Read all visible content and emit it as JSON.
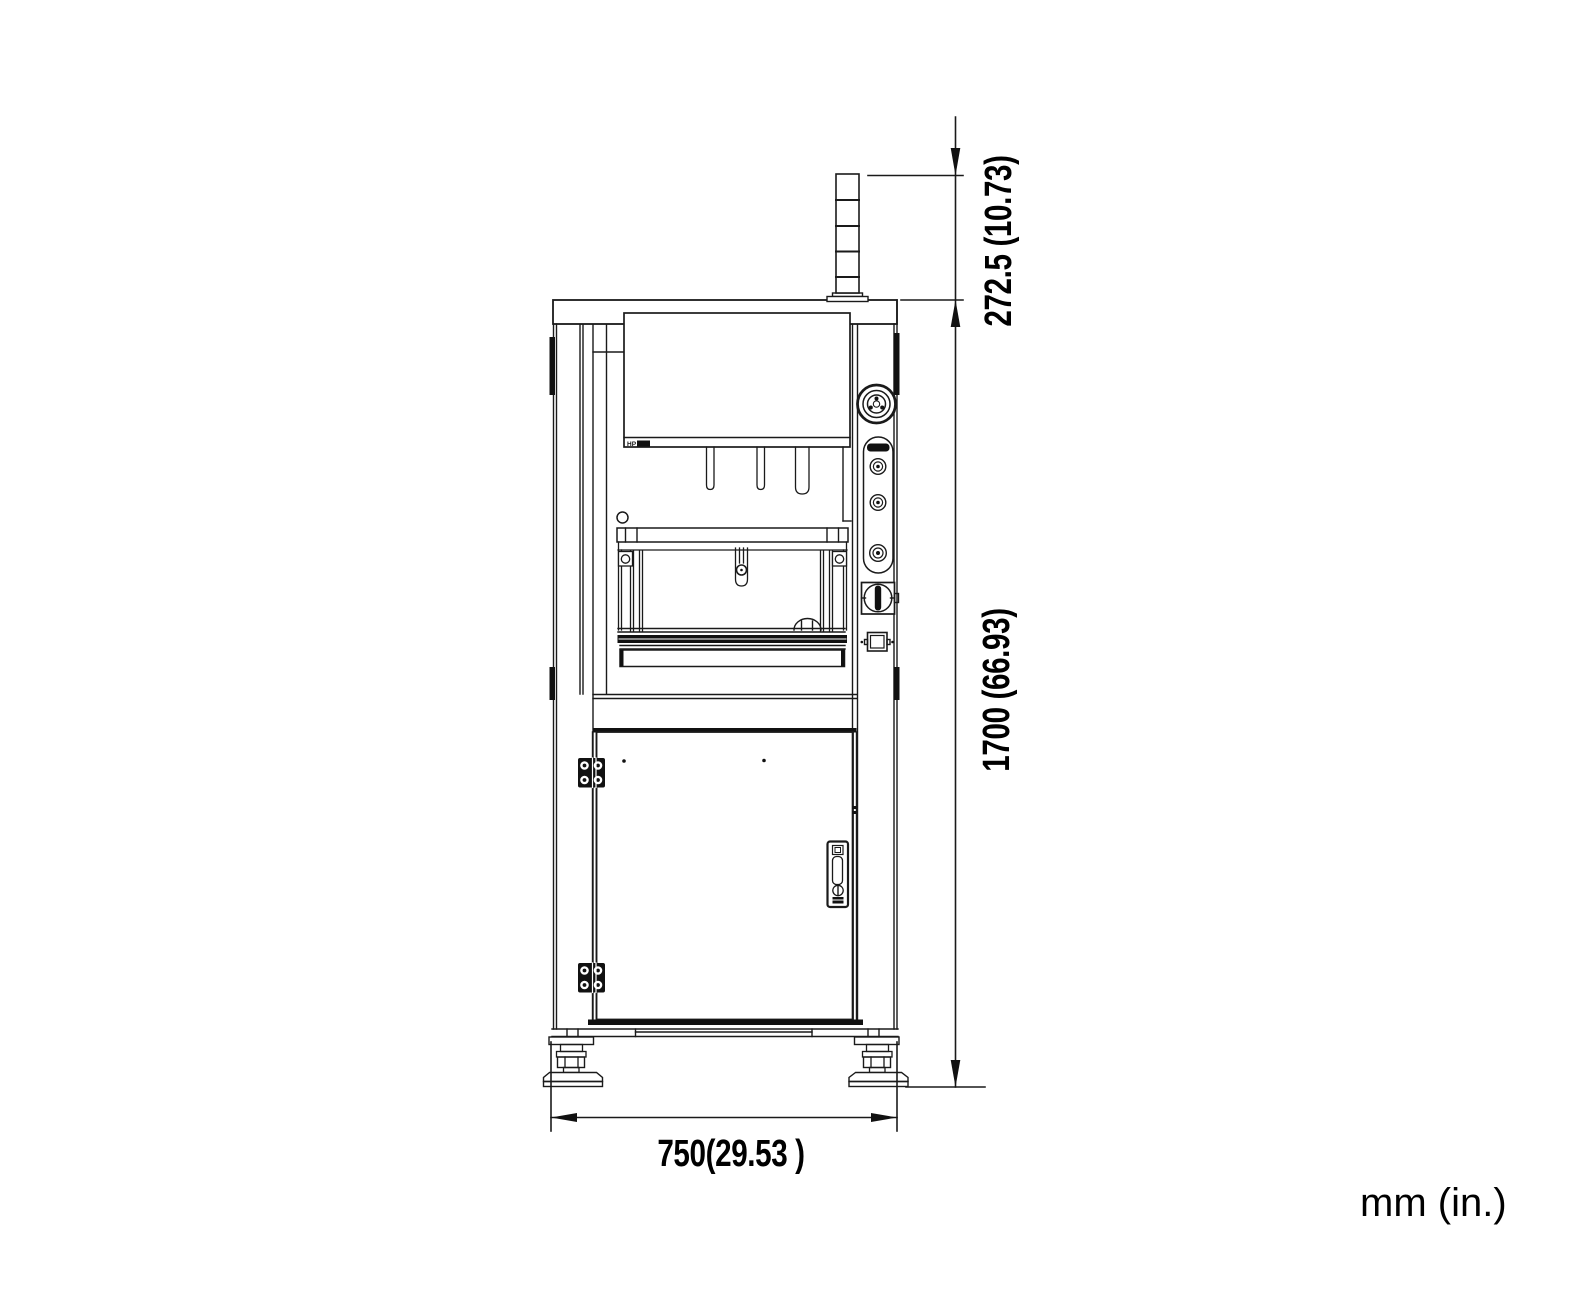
{
  "meta": {
    "drawing_type": "technical dimension drawing, machine front view",
    "background_color": "#ffffff",
    "line_color": "#1a1a1a"
  },
  "machine": {
    "panel_model": "HP"
  },
  "dimensions": {
    "tower_height": {
      "label": "272.5 (10.73)",
      "mm": 272.5,
      "inches": 10.73
    },
    "overall_height": {
      "label": "1700 (66.93)",
      "mm": 1700,
      "inches": 66.93
    },
    "base_width": {
      "label": "750(29.53 )",
      "mm": 750,
      "inches": 29.53
    }
  },
  "units_label": "mm (in.)"
}
